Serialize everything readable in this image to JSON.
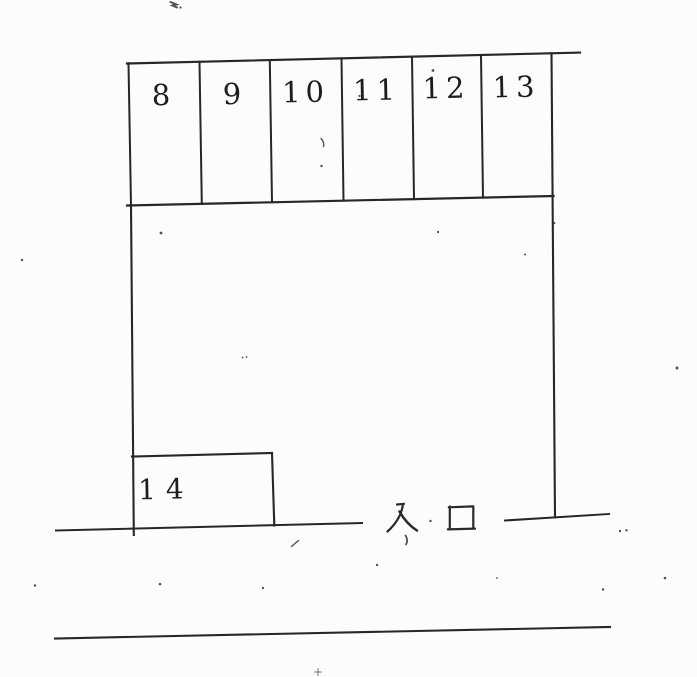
{
  "stalls": {
    "top_row": [
      {
        "number": "8"
      },
      {
        "number": "9"
      },
      {
        "number": "10"
      },
      {
        "number": "11"
      },
      {
        "number": "12"
      },
      {
        "number": "13"
      }
    ],
    "bottom": {
      "number": "14"
    }
  },
  "entrance": {
    "label": "入口"
  },
  "colors": {
    "ink": "#272727",
    "paper": "#fcfcfa"
  }
}
